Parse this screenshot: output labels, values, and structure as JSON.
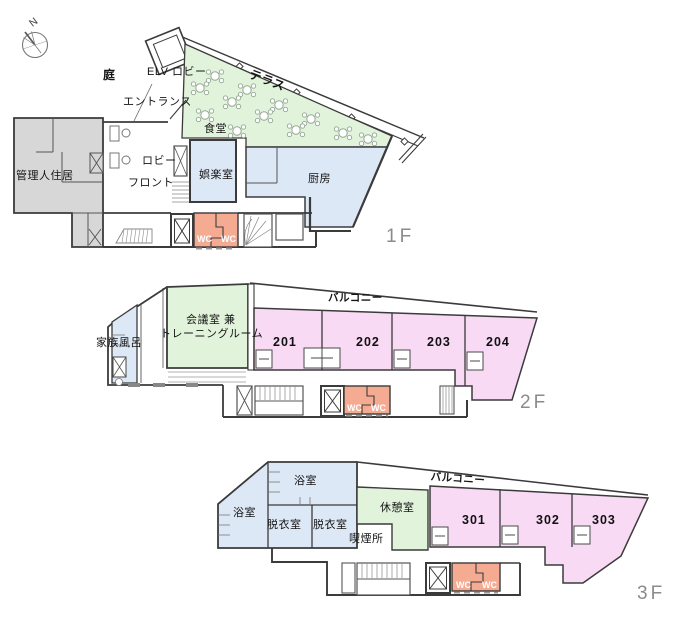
{
  "common": {
    "wc_label": "WC",
    "north_label": "N"
  },
  "colors": {
    "room_green": "#e2f3dc",
    "room_blue": "#dde8f6",
    "room_pink": "#f8daf4",
    "wc_salmon": "#f5ab92",
    "residence_gray": "#d7d7d7",
    "wall": "#3b3b3b",
    "floor_label_gray": "#8b8b8b"
  },
  "floor1": {
    "floor_label": "1F",
    "labels": {
      "garden": "庭",
      "elv_lobby": "ELV ロビー",
      "entrance": "エントランス",
      "terrace": "テラス",
      "dining_room": "食堂",
      "lobby": "ロビー",
      "front_desk": "フロント",
      "manager_residence": "管理人住居",
      "recreation_room": "娯楽室",
      "kitchen": "厨房"
    }
  },
  "floor2": {
    "floor_label": "2F",
    "labels": {
      "balcony": "バルコニー",
      "meeting_room_line1": "会議室 兼",
      "meeting_room_line2": "トレーニングルーム",
      "family_bath": "家族風呂",
      "room_201": "201",
      "room_202": "202",
      "room_203": "203",
      "room_204": "204"
    }
  },
  "floor3": {
    "floor_label": "3F",
    "labels": {
      "balcony": "バルコニー",
      "bath_upper": "浴室",
      "bath_left": "浴室",
      "dressing_room_1": "脱衣室",
      "dressing_room_2": "脱衣室",
      "rest_room": "休憩室",
      "smoking_area": "喫煙所",
      "room_301": "301",
      "room_302": "302",
      "room_303": "303"
    }
  }
}
